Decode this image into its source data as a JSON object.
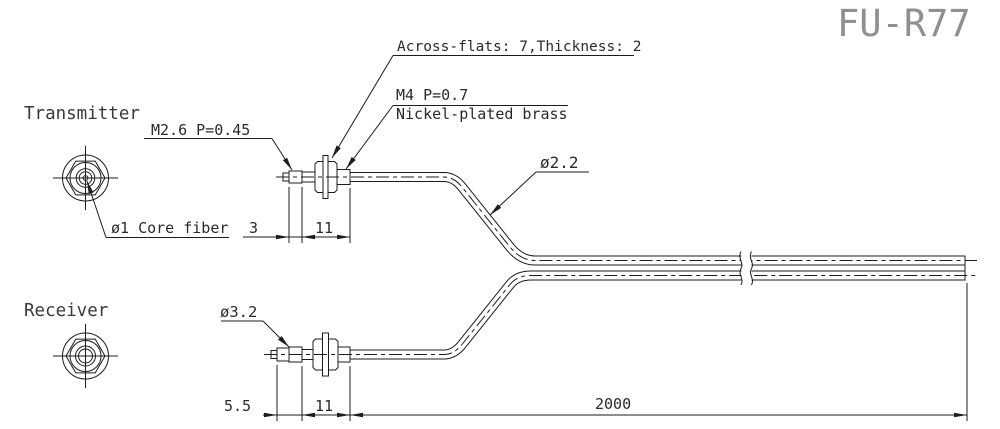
{
  "drawing": {
    "title": "FU-R77",
    "part_views": {
      "transmitter": {
        "label": "Transmitter"
      },
      "receiver": {
        "label": "Receiver"
      }
    },
    "callouts": {
      "across_flats": "Across-flats: 7,Thickness: 2",
      "m4_thread": "M4  P=0.7",
      "material": "Nickel-plated brass",
      "m26_thread": "M2.6  P=0.45",
      "cable_diameter": "ø2.2",
      "core_fiber": "ø1 Core fiber",
      "receiver_fiber_diameter": "ø3.2"
    },
    "dimensions": {
      "transmitter_tip_length": "3",
      "transmitter_body_length": "11",
      "receiver_tip_length": "5.5",
      "receiver_body_length": "11",
      "cable_length": "2000"
    },
    "colors": {
      "background": "#ffffff",
      "line": "#1c1c1c",
      "label_text": "#2a2a2a",
      "title_text": "#8f8f8f"
    }
  }
}
